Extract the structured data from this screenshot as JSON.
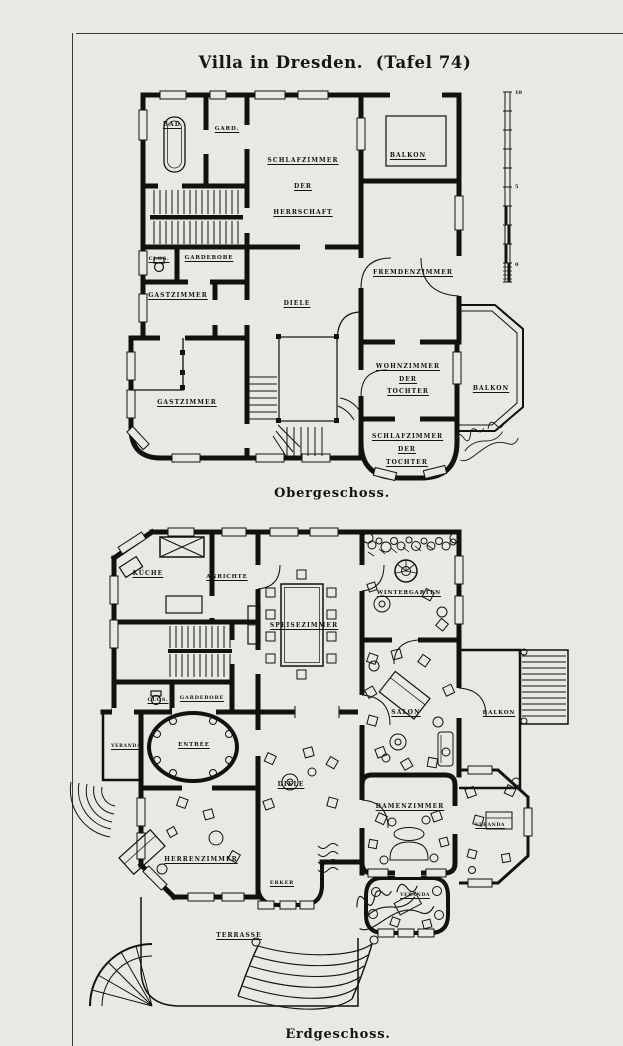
{
  "page": {
    "title": "Villa in Dresden.  (Tafel 74)"
  },
  "obergeschoss": {
    "caption": "Obergeschoss.",
    "rooms": {
      "bad": "Bad",
      "gard": "Gard.",
      "schlafzimmer_herrschaft": "Schlafzimmer\nder\nHerrschaft",
      "balkon_oben": "Balkon",
      "clos": "Clos.",
      "garderobe": "Garderobe",
      "gastzimmer_1": "Gastzimmer",
      "diele": "Diele",
      "fremdenzimmer": "Fremdenzimmer",
      "gastzimmer_2": "Gastzimmer",
      "wohnzimmer_tochter": "Wohnzimmer\nder\nTochter",
      "balkon_seite": "Balkon",
      "schlafzimmer_tochter": "Schlafzimmer\nder\nTochter"
    },
    "scale_bar": {
      "top": "10",
      "mid": "5",
      "bottom": "0"
    }
  },
  "erdgeschoss": {
    "caption": "Erdgeschoss.",
    "rooms": {
      "kueche": "Küche",
      "anrichte": "Anrichte",
      "speisezimmer": "Speisezimmer",
      "wintergarten": "Wintergarten",
      "salon": "Salon",
      "balkon": "Balkon",
      "clos": "Clos.",
      "garderobe": "Garderobe",
      "entree": "Entrée",
      "veranda_west": "Veranda",
      "diele": "Diele",
      "herrenzimmer": "Herrenzimmer",
      "erker": "Erker",
      "damenzimmer": "Damenzimmer",
      "veranda_ost": "Veranda",
      "veranda_sued": "Veranda",
      "terrasse": "Terrasse"
    }
  }
}
